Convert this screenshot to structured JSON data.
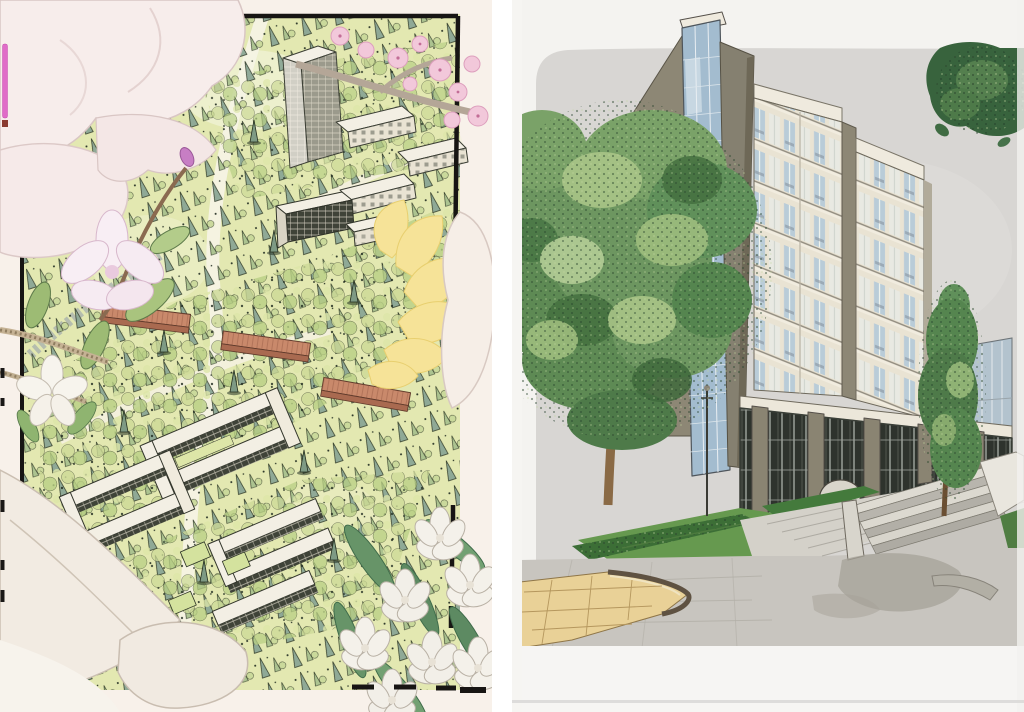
{
  "scene": {
    "kind": "photo-of-two-hand-drawn-architectural-renderings",
    "left_panel_name": "campus-aerial-master-plan-rendering",
    "right_panel_name": "high-rise-building-perspective-rendering"
  },
  "palette": {
    "left": {
      "paper": "#f8f1ea",
      "petal": "#f7edeb",
      "lawn": "#e3e8b1",
      "ink": "#22281f",
      "conifer_teal": "#8ba695",
      "foliage_light": "#c4d692",
      "building_white": "#f4f0e6",
      "facade_dark": "#3f4338",
      "roof_red": "#c9896b",
      "blossom_pink": "#f2c8da",
      "accent_magenta": "#e06cc8",
      "ginkgo_yellow": "#f6e398",
      "leaf_green": "#6d9a6e",
      "frame_black": "#171513"
    },
    "right": {
      "paper": "#f4f3f0",
      "sky": "#d8d6d3",
      "wall_olive": "#8d8775",
      "glass_blue": "#a3bccf",
      "facade_cream": "#e9e3d3",
      "window_blue": "#b9ccd8",
      "glazing_dark": "#2e332d",
      "hedge_green": "#3c6e36",
      "lawn_green": "#66994f",
      "tree_green": "#6d9660",
      "trunk_brown": "#8a6a45",
      "plaza_gray": "#c8c5bf",
      "paving_tan": "#e9d197",
      "shadow_gray": "#a5a298"
    }
  }
}
